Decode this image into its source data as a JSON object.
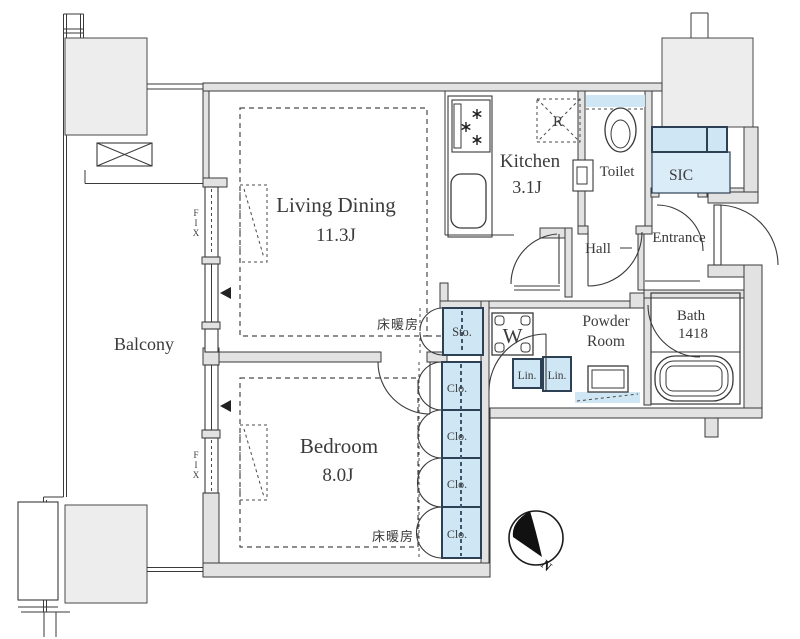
{
  "plan": {
    "rooms": {
      "living_dining": {
        "label": "Living Dining",
        "size": "11.3J"
      },
      "kitchen": {
        "label": "Kitchen",
        "size": "3.1J"
      },
      "bedroom": {
        "label": "Bedroom",
        "size": "8.0J"
      },
      "balcony": {
        "label": "Balcony"
      },
      "toilet": {
        "label": "Toilet"
      },
      "sic": {
        "label": "SIC"
      },
      "entrance": {
        "label": "Entrance"
      },
      "hall": {
        "label": "Hall"
      },
      "powder_room": {
        "label_line1": "Powder",
        "label_line2": "Room"
      },
      "bath": {
        "label": "Bath",
        "size": "1418"
      }
    },
    "storage": {
      "storage_label": "Sto.",
      "closet_label": "Clo.",
      "linen_label": "Lin."
    },
    "fixtures": {
      "washer_label": "W",
      "refrigerator_label": "R"
    },
    "annotations": {
      "floor_heating_label": "床暖房",
      "fixed_window_label": "FIX",
      "north_label": "N"
    },
    "colors": {
      "highlight_blue": "#cfe7f5",
      "wall_gray": "#e2e2e2",
      "structure_gray": "#ededed",
      "line_dark": "#3a3a3a"
    }
  }
}
